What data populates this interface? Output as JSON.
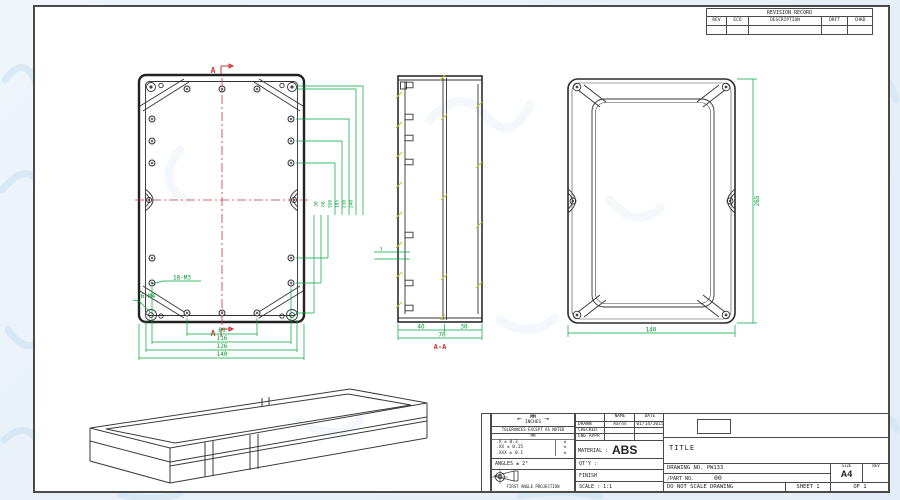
{
  "colors": {
    "dimension_green": "#00a53c",
    "centerline_red": "#cc3333",
    "hatch_yellow": "#c9c929",
    "line_dark": "#222222",
    "watermark_blue": "#d4e5f3"
  },
  "revision_table": {
    "title": "REVISION RECORD",
    "columns": [
      "REV",
      "ECO",
      "DESCRIPTION",
      "DRFT",
      "CHKD"
    ]
  },
  "front_view": {
    "section_label_top": "A",
    "section_label_bottom": "A",
    "label_m3": "18-M3",
    "label_m4": "6-M4",
    "dim_60": "60",
    "dim_116": "116",
    "dim_126": "126",
    "dim_140": "140",
    "stack_dims": [
      "240",
      "210",
      "185",
      "160",
      "60",
      "30"
    ]
  },
  "section_view": {
    "dim_40": "40",
    "dim_30": "30",
    "dim_70": "70",
    "dim_3": "3",
    "label": "A-A"
  },
  "rear_view": {
    "dim_height": "265",
    "dim_width": "140"
  },
  "title_block": {
    "side_label": "DETACHED LISTS",
    "units_mm": "MM",
    "units_inches": "INCHES",
    "tolerances_heading": "TOLERANCES EXCEPT AS NOTED",
    "tol_col_header": "MM",
    "tol_rows": [
      {
        "mm": ".X ± 0.3",
        "in": "±"
      },
      {
        "mm": ".XX ± 0.15",
        "in": "±"
      },
      {
        "mm": ".XXX ± 0.1",
        "in": "±"
      }
    ],
    "angles": "ANGLES ± 2°",
    "projection_label": "FIRST ANGLE PROJECTION",
    "name_header": "NAME",
    "date_header": "DATE",
    "drawn_label": "DRAWN",
    "drawn_name": "Aaron",
    "drawn_date": "01/14/2015",
    "checked_label": "CHECKED",
    "eng_appr_label": "ENG APPR",
    "material_label": "MATERIAL :",
    "material_value": "ABS",
    "qty_label": "QT'Y :",
    "finish_label": "FINISH",
    "scale_label": "SCALE : 1:1",
    "title_label": "TITLE",
    "drawing_no": "DRAWING NO. PW133",
    "part_no_label": "/PART NO.",
    "part_no_value": "00",
    "size_label": "SIZE",
    "size_value": "A4",
    "rev_label": "REV",
    "do_not_scale": "DO NOT SCALE DRAWING",
    "sheet_label": "SHEET 1",
    "of_label": "OF 1"
  }
}
